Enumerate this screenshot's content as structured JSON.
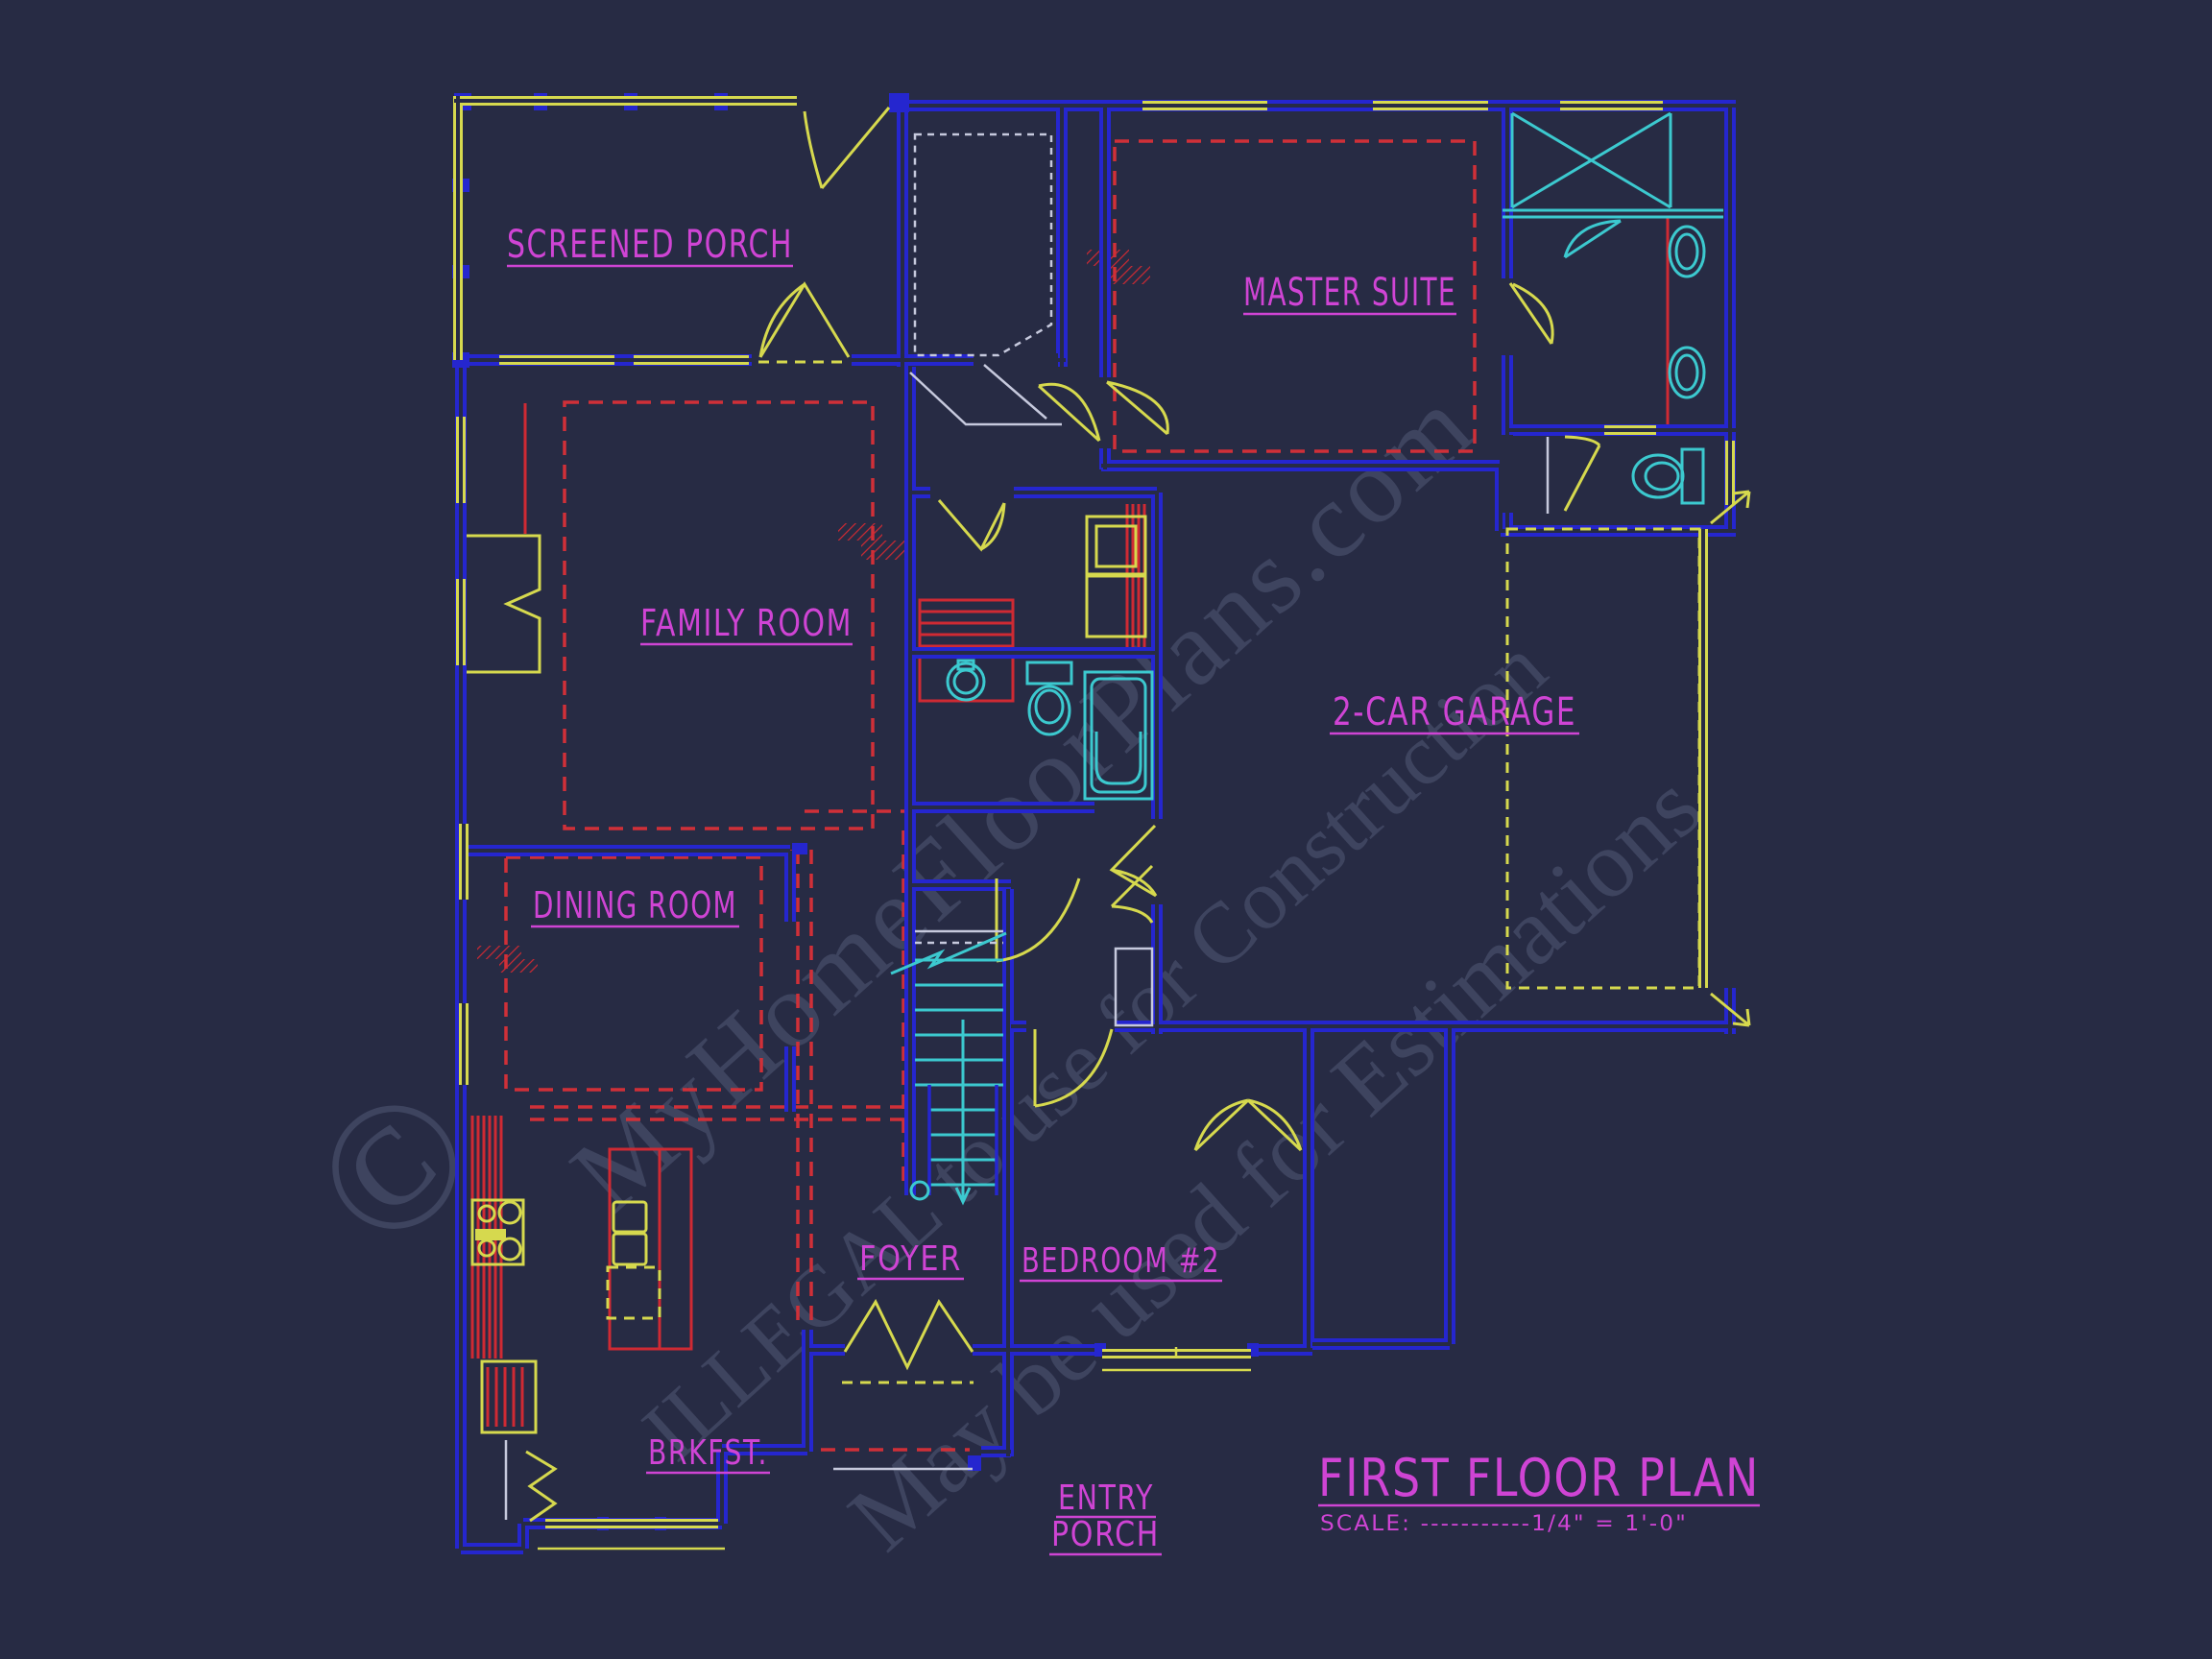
{
  "drawing": {
    "type": "architectural-floor-plan",
    "background_color": "#272b44",
    "title": "FIRST FLOOR PLAN",
    "scale_note": "SCALE: -----------1/4\" = 1'-0\"",
    "colors": {
      "walls_blue": "#2526cf",
      "doors_windows_yellow": "#d6d94e",
      "ceiling_red": "#cf2a33",
      "plumbing_cyan": "#3cc9cf",
      "labels_magenta": "#cf44d4",
      "misc_white": "#c6c9dd",
      "watermark_gray": "#414763"
    },
    "rooms": [
      {
        "id": "screened-porch",
        "label": "SCREENED PORCH"
      },
      {
        "id": "master-suite",
        "label": "MASTER SUITE"
      },
      {
        "id": "family-room",
        "label": "FAMILY ROOM"
      },
      {
        "id": "garage",
        "label": "2-CAR GARAGE"
      },
      {
        "id": "dining-room",
        "label": "DINING ROOM"
      },
      {
        "id": "foyer",
        "label": "FOYER"
      },
      {
        "id": "bedroom-2",
        "label": "BEDROOM #2"
      },
      {
        "id": "breakfast",
        "label": "BRKFST."
      },
      {
        "id": "entry-porch-1",
        "label": "ENTRY"
      },
      {
        "id": "entry-porch-2",
        "label": "PORCH"
      }
    ],
    "watermark": {
      "symbol": "©",
      "line1": "MyHomeFloorPlans.com",
      "line2": "ILLEGAL to use for Construction",
      "line3": "May be used for Estimations"
    },
    "fixtures": [
      "shower",
      "vanity-sink",
      "vanity-sink",
      "toilet-master",
      "toilet-hall-bath",
      "pedestal-sink",
      "bathtub",
      "range-stove",
      "kitchen-island",
      "base-cabinet",
      "furnace-cabinet",
      "fireplace",
      "staircase-up",
      "garage-door",
      "front-double-door"
    ]
  }
}
